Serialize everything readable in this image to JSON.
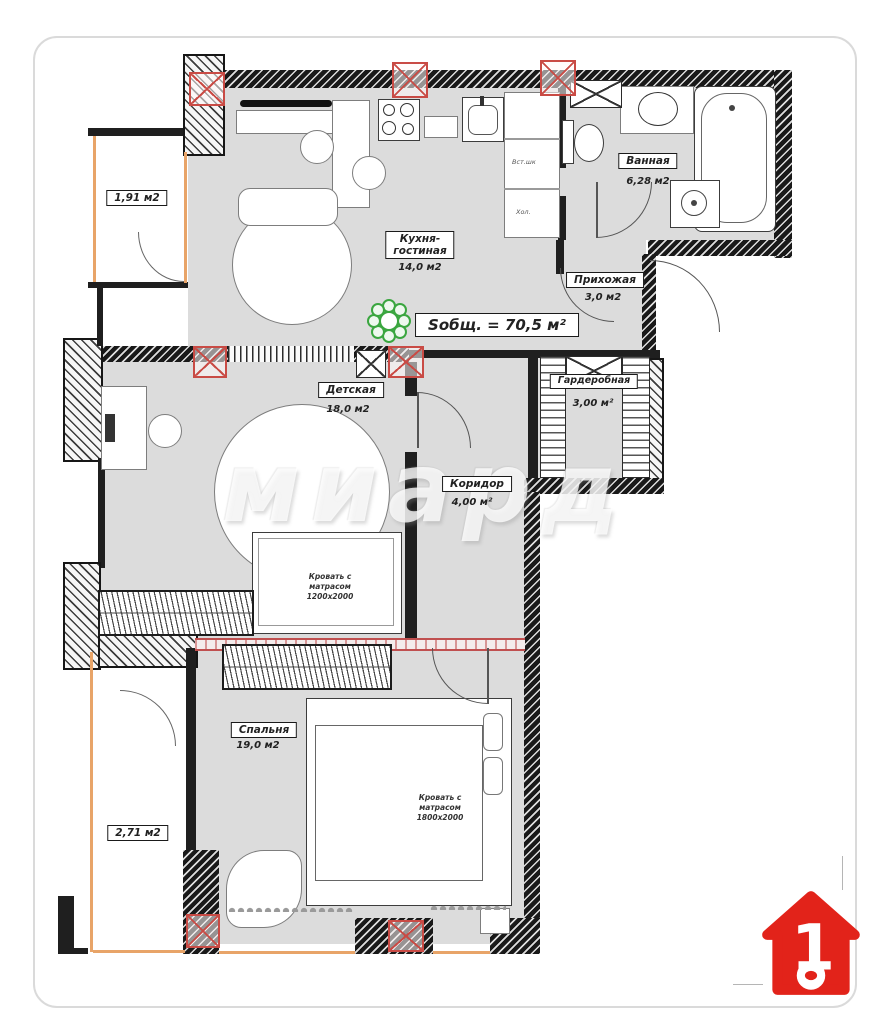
{
  "plan": {
    "total_area": "Sобщ. = 70,5 м²",
    "watermark": "миард",
    "rooms": {
      "kitchen": {
        "name": "Кухня-\nгостиная",
        "area": "14,0 м2"
      },
      "bathroom": {
        "name": "Ванная",
        "area": "6,28 м2"
      },
      "hallway": {
        "name": "Прихожая",
        "area": "3,0 м2"
      },
      "wardrobe": {
        "name": "Гардеробная",
        "area": "3,00 м²"
      },
      "kids_room": {
        "name": "Детская",
        "area": "18,0 м2"
      },
      "corridor": {
        "name": "Коридор",
        "area": "4,00 м²"
      },
      "bedroom": {
        "name": "Спальня",
        "area": "19,0 м2"
      }
    },
    "balconies": {
      "top": {
        "area": "1,91 м2"
      },
      "bottom": {
        "area": "2,71 м2"
      }
    },
    "furniture_labels": {
      "kids_bed": "Кровать с\nматрасом\n1200х2000",
      "master_bed": "Кровать с\nматрасом\n1800х2000",
      "cabinet_mid": "Вст.шк",
      "cabinet_bottom": "Хол."
    },
    "logo": {
      "number": "1"
    },
    "colors": {
      "logo_red": "#e2231a",
      "column_marker_red": "#c94b45",
      "window_orange": "#e8a468",
      "floor_gray": "#dcdcdc"
    }
  }
}
